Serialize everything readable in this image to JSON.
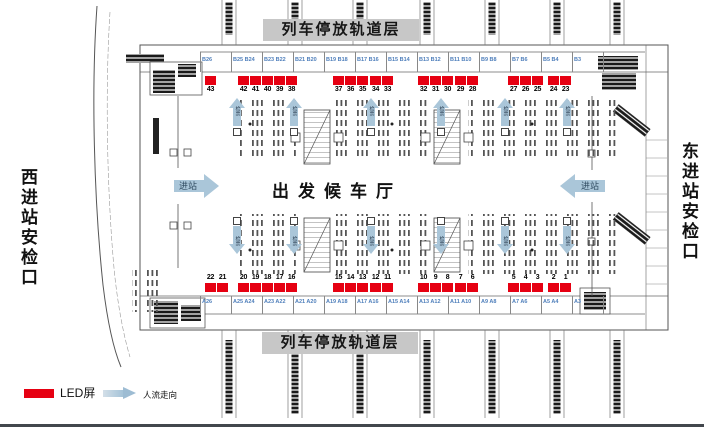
{
  "plan": {
    "banners": {
      "top": "列车停放轨道层",
      "bottom": "列车停放轨道层"
    },
    "sides": {
      "west": "西进站安检口",
      "east": "东进站安检口"
    },
    "hall": {
      "title": "出发候车厅",
      "enter_label": "进站",
      "check_label": "检票"
    }
  },
  "led": {
    "top_groups": [
      [
        "43"
      ],
      [
        "42",
        "41",
        "40"
      ],
      [
        "39",
        "38"
      ],
      [
        "37",
        "36",
        "35"
      ],
      [
        "34",
        "33"
      ],
      [
        "32",
        "31",
        "30"
      ],
      [
        "29",
        "28"
      ],
      [
        "27",
        "26",
        "25"
      ],
      [
        "24",
        "23"
      ]
    ],
    "bottom_groups": [
      [
        "22",
        "21"
      ],
      [
        "20",
        "19",
        "18"
      ],
      [
        "17",
        "16"
      ],
      [
        "15",
        "14",
        "13"
      ],
      [
        "12",
        "11"
      ],
      [
        "10",
        "9",
        "8"
      ],
      [
        "7",
        "6"
      ],
      [
        "5",
        "4",
        "3"
      ],
      [
        "2",
        "1"
      ]
    ]
  },
  "gates": {
    "top": [
      "B26",
      "B25 B24",
      "B23 B22",
      "B21 B20",
      "B19 B18",
      "B17 B16",
      "B15 B14",
      "B13 B12",
      "B11 B10",
      "B9 B8",
      "B7 B6",
      "B5 B4",
      "B3"
    ],
    "bottom": [
      "A26",
      "A25 A24",
      "A23 A22",
      "A21 A20",
      "A19 A18",
      "A17 A16",
      "A15 A14",
      "A13 A12",
      "A11 A10",
      "A9 A8",
      "A7 A6",
      "A5 A4",
      "A3"
    ]
  },
  "legend": {
    "led_label": "LED屏",
    "flow_label": "人流走向"
  },
  "colors": {
    "led_red": "#e60012",
    "gate_blue": "#4f7fbb",
    "arrow_blue": "#aac6d9",
    "banner_gray": "#c7c7c7"
  }
}
